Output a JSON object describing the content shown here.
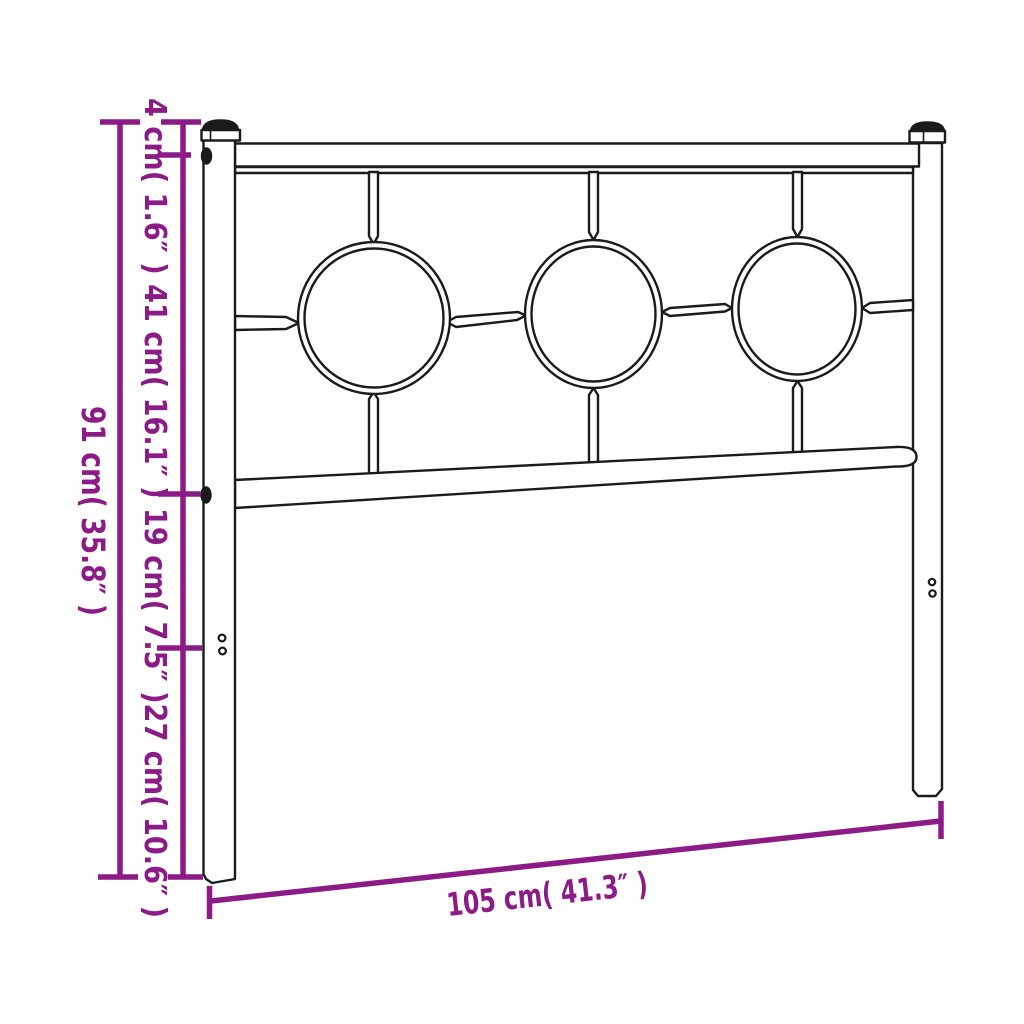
{
  "diagram": {
    "type": "product-dimension-diagram",
    "subject": "metal bed headboard with three circle ornaments",
    "colors": {
      "outline": "#1b1b1b",
      "dimension": "#8C1B87",
      "background": "#ffffff"
    },
    "dimensions": {
      "overall_height_label": "91 cm( 35.8″ )",
      "segment_heights_label": "4 cm( 1.6″ ) 41 cm( 16.1″ ) 19 cm( 7.5″ )27 cm( 10.6″ )",
      "segments": [
        "4 cm( 1.6″ )",
        "41 cm( 16.1″ )",
        "19 cm( 7.5″ )",
        "27 cm( 10.6″ )"
      ],
      "width_label": "105 cm( 41.3″ )"
    }
  }
}
